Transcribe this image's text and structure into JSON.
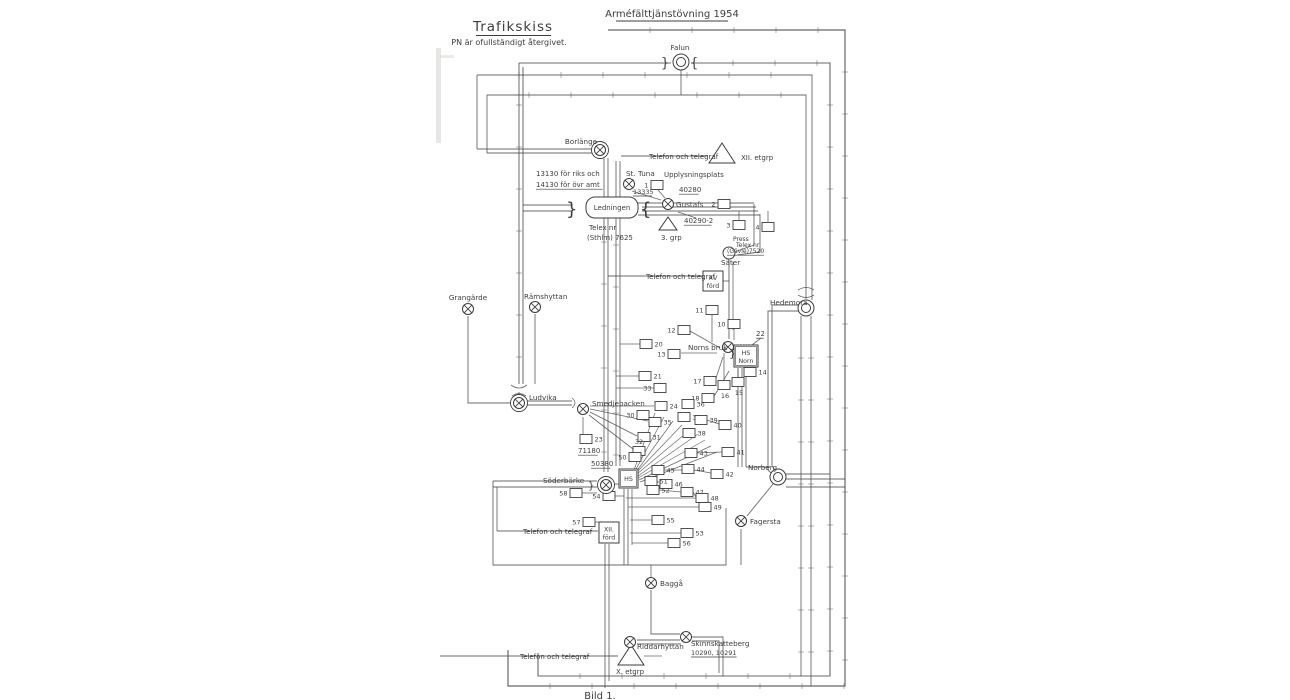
{
  "page": {
    "title": "Trafikskiss",
    "note": "PN är ofullständigt återgivet.",
    "exercise": "Arméfälttjänstövning 1954",
    "caption": "Bild 1."
  },
  "colors": {
    "ink": "#3d3d3d",
    "wire": "#4d4d4d",
    "paper": "#ffffff"
  },
  "stations": [
    {
      "id": "falun",
      "label": "Falun",
      "type": "cc",
      "x": 681,
      "y": 62,
      "lx": 680,
      "ly": 50,
      "anchor": "middle"
    },
    {
      "id": "borlange",
      "label": "Borlänge",
      "type": "cxr",
      "x": 600,
      "y": 150,
      "lx": 581,
      "ly": 144,
      "anchor": "middle"
    },
    {
      "id": "st-tuna",
      "label": "St. Tuna",
      "type": "cx",
      "x": 629,
      "y": 184,
      "lx": 626,
      "ly": 176,
      "anchor": "start",
      "number": "13335",
      "nx": 633,
      "ny": 194
    },
    {
      "id": "gustafs",
      "label": "Gustafs",
      "type": "cx",
      "x": 668,
      "y": 204,
      "lx": 676,
      "ly": 207,
      "anchor": "start"
    },
    {
      "id": "sater",
      "label": "Säter",
      "type": "c",
      "x": 729,
      "y": 253,
      "lx": 721,
      "ly": 265,
      "anchor": "start"
    },
    {
      "id": "hedemora",
      "label": "Hedemora",
      "type": "cc",
      "x": 806,
      "y": 308,
      "lx": 770,
      "ly": 305,
      "anchor": "start"
    },
    {
      "id": "grangarde",
      "label": "Grangärde",
      "type": "cx",
      "x": 468,
      "y": 309,
      "lx": 468,
      "ly": 300,
      "anchor": "middle"
    },
    {
      "id": "ramshyttan",
      "label": "Rämshyttan",
      "type": "cx",
      "x": 535,
      "y": 307,
      "lx": 524,
      "ly": 299,
      "anchor": "start"
    },
    {
      "id": "ludvika",
      "label": "Ludvika",
      "type": "cxr",
      "x": 519,
      "y": 403,
      "lx": 529,
      "ly": 400,
      "anchor": "start"
    },
    {
      "id": "smedjebacken",
      "label": "Smedjebacken",
      "type": "cx",
      "x": 583,
      "y": 409,
      "lx": 592,
      "ly": 406,
      "anchor": "start"
    },
    {
      "id": "norns-bruk",
      "label": "Norns bruk",
      "type": "cx",
      "x": 728,
      "y": 347,
      "lx": 688,
      "ly": 350,
      "anchor": "start"
    },
    {
      "id": "soderbarke",
      "label": "Söderbärke",
      "type": "cxr",
      "x": 606,
      "y": 485,
      "lx": 543,
      "ly": 483,
      "anchor": "start"
    },
    {
      "id": "norberg",
      "label": "Norberg",
      "type": "cc",
      "x": 778,
      "y": 477,
      "lx": 748,
      "ly": 470,
      "anchor": "start"
    },
    {
      "id": "fagersta",
      "label": "Fagersta",
      "type": "cx",
      "x": 741,
      "y": 521,
      "lx": 750,
      "ly": 524,
      "anchor": "start"
    },
    {
      "id": "bagga",
      "label": "Baggå",
      "type": "cx",
      "x": 651,
      "y": 583,
      "lx": 660,
      "ly": 586,
      "anchor": "start"
    },
    {
      "id": "riddarhyttan",
      "label": "Riddarhyttan",
      "type": "cx",
      "x": 630,
      "y": 642,
      "lx": 637,
      "ly": 649,
      "anchor": "start"
    },
    {
      "id": "skinnskatteberg",
      "label": "Skinnskatteberg",
      "type": "cx",
      "x": 686,
      "y": 637,
      "lx": 691,
      "ly": 646,
      "anchor": "start",
      "number": "10290, 10291",
      "nx": 691,
      "ny": 655
    }
  ],
  "units": [
    {
      "id": "etgrp-xii",
      "type": "triangle",
      "label": "XII. etgrp",
      "points": "722,143 709,163 735,163",
      "lx": 741,
      "ly": 160
    },
    {
      "id": "grp-3",
      "type": "triangle",
      "label": "3. grp",
      "points": "668,217 659,230 677,230",
      "lx": 661,
      "ly": 240
    },
    {
      "id": "etgrp-x",
      "type": "triangle",
      "label": "X. etgrp",
      "points": "631,645 618,665 644,665",
      "lx": 616,
      "ly": 674
    },
    {
      "id": "ford-xv",
      "type": "box",
      "lines": [
        "XV",
        "förd"
      ],
      "x": 703,
      "y": 271,
      "w": 20,
      "h": 20
    },
    {
      "id": "ford-xii",
      "type": "box",
      "lines": [
        "XII.",
        "förd"
      ],
      "x": 599,
      "y": 522,
      "w": 20,
      "h": 21
    },
    {
      "id": "hs-norn",
      "type": "box2",
      "lines": [
        "HS",
        "Norn"
      ],
      "x": 734,
      "y": 345,
      "w": 24,
      "h": 22
    },
    {
      "id": "hs",
      "type": "box2",
      "lines": [
        "HS"
      ],
      "x": 619,
      "y": 469,
      "w": 19,
      "h": 19
    },
    {
      "id": "ledningen",
      "type": "rbox",
      "lines": [
        "Ledningen"
      ],
      "x": 586,
      "y": 197,
      "w": 52,
      "h": 21
    }
  ],
  "terminals": [
    {
      "n": "1",
      "x": 657,
      "y": 185,
      "side": "l"
    },
    {
      "n": "2",
      "x": 724,
      "y": 204,
      "side": "l"
    },
    {
      "n": "3",
      "x": 739,
      "y": 225,
      "side": "l"
    },
    {
      "n": "4",
      "x": 768,
      "y": 227,
      "side": "l"
    },
    {
      "n": "10",
      "x": 734,
      "y": 324,
      "side": "l"
    },
    {
      "n": "11",
      "x": 712,
      "y": 310,
      "side": "l"
    },
    {
      "n": "12",
      "x": 684,
      "y": 330,
      "side": "l"
    },
    {
      "n": "13",
      "x": 674,
      "y": 354,
      "side": "l"
    },
    {
      "n": "14",
      "x": 750,
      "y": 372,
      "side": "r"
    },
    {
      "n": "15",
      "x": 738,
      "y": 382,
      "side": "b"
    },
    {
      "n": "16",
      "x": 724,
      "y": 385,
      "side": "b"
    },
    {
      "n": "17",
      "x": 710,
      "y": 381,
      "side": "l"
    },
    {
      "n": "18",
      "x": 708,
      "y": 398,
      "side": "l"
    },
    {
      "n": "20",
      "x": 646,
      "y": 344,
      "side": "r"
    },
    {
      "n": "21",
      "x": 645,
      "y": 376,
      "side": "r"
    },
    {
      "n": "23",
      "x": 586,
      "y": 439,
      "side": "r"
    },
    {
      "n": "24",
      "x": 661,
      "y": 406,
      "side": "r"
    },
    {
      "n": "30",
      "x": 643,
      "y": 415,
      "side": "l"
    },
    {
      "n": "31",
      "x": 644,
      "y": 437,
      "side": "r"
    },
    {
      "n": "32",
      "x": 639,
      "y": 451,
      "side": "t"
    },
    {
      "n": "33",
      "x": 660,
      "y": 388,
      "side": "l"
    },
    {
      "n": "35",
      "x": 655,
      "y": 422,
      "side": "r"
    },
    {
      "n": "36",
      "x": 688,
      "y": 404,
      "side": "r"
    },
    {
      "n": "37",
      "x": 684,
      "y": 417,
      "side": "r"
    },
    {
      "n": "38",
      "x": 689,
      "y": 433,
      "side": "r"
    },
    {
      "n": "39",
      "x": 701,
      "y": 420,
      "side": "r"
    },
    {
      "n": "40",
      "x": 725,
      "y": 425,
      "side": "r"
    },
    {
      "n": "41",
      "x": 728,
      "y": 452,
      "side": "r"
    },
    {
      "n": "42",
      "x": 717,
      "y": 474,
      "side": "r"
    },
    {
      "n": "43",
      "x": 691,
      "y": 453,
      "side": "r"
    },
    {
      "n": "44",
      "x": 688,
      "y": 469,
      "side": "r"
    },
    {
      "n": "45",
      "x": 658,
      "y": 470,
      "side": "r"
    },
    {
      "n": "46",
      "x": 666,
      "y": 484,
      "side": "r"
    },
    {
      "n": "47",
      "x": 687,
      "y": 492,
      "side": "r"
    },
    {
      "n": "48",
      "x": 702,
      "y": 498,
      "side": "r"
    },
    {
      "n": "49",
      "x": 705,
      "y": 507,
      "side": "r"
    },
    {
      "n": "50",
      "x": 635,
      "y": 457,
      "side": "l"
    },
    {
      "n": "51",
      "x": 651,
      "y": 481,
      "side": "r"
    },
    {
      "n": "52",
      "x": 653,
      "y": 490,
      "side": "r"
    },
    {
      "n": "53",
      "x": 687,
      "y": 533,
      "side": "r"
    },
    {
      "n": "54",
      "x": 609,
      "y": 496,
      "side": "l"
    },
    {
      "n": "55",
      "x": 658,
      "y": 520,
      "side": "r"
    },
    {
      "n": "56",
      "x": 674,
      "y": 543,
      "side": "r"
    },
    {
      "n": "57",
      "x": 589,
      "y": 522,
      "side": "l"
    },
    {
      "n": "58",
      "x": 576,
      "y": 493,
      "side": "l"
    }
  ],
  "annotations": [
    {
      "text": "Telefon och telegraf",
      "x": 649,
      "y": 159
    },
    {
      "text": "13130 för riks och",
      "x": 536,
      "y": 176
    },
    {
      "text": "14130 för övr amt",
      "x": 536,
      "y": 187,
      "underline": true
    },
    {
      "text": "Telex nr",
      "x": 589,
      "y": 230
    },
    {
      "text": "(Sthlm) 7625",
      "x": 587,
      "y": 240
    },
    {
      "text": "Upplysningsplats",
      "x": 664,
      "y": 177
    },
    {
      "text": "40280",
      "x": 679,
      "y": 192,
      "underline": true
    },
    {
      "text": "40290-2",
      "x": 684,
      "y": 223,
      "underline": true
    },
    {
      "text": "Press",
      "x": 733,
      "y": 241,
      "size": 6
    },
    {
      "text": "Telex nr",
      "x": 736,
      "y": 247,
      "size": 6
    },
    {
      "text": "(Gävle)7520",
      "x": 727,
      "y": 253,
      "size": 6,
      "underline": true
    },
    {
      "text": "Telefon och telegraf",
      "x": 646,
      "y": 279
    },
    {
      "text": "22",
      "x": 756,
      "y": 336,
      "underline": true
    },
    {
      "text": "71180",
      "x": 578,
      "y": 453,
      "underline": true
    },
    {
      "text": "50380",
      "x": 591,
      "y": 466,
      "underline": true
    },
    {
      "text": "Telefon och telegraf",
      "x": 523,
      "y": 534
    },
    {
      "text": "Telefon och telegraf",
      "x": 520,
      "y": 659
    },
    {
      "text": "}",
      "x": 566,
      "y": 215,
      "size": 18
    },
    {
      "text": "{",
      "x": 640,
      "y": 215,
      "size": 18
    },
    {
      "text": "}",
      "x": 661,
      "y": 67,
      "size": 13
    },
    {
      "text": "{",
      "x": 690,
      "y": 67,
      "size": 13
    },
    {
      "text": "}",
      "x": 729,
      "y": 357,
      "size": 11
    },
    {
      "text": "}",
      "x": 588,
      "y": 489,
      "size": 10
    }
  ]
}
